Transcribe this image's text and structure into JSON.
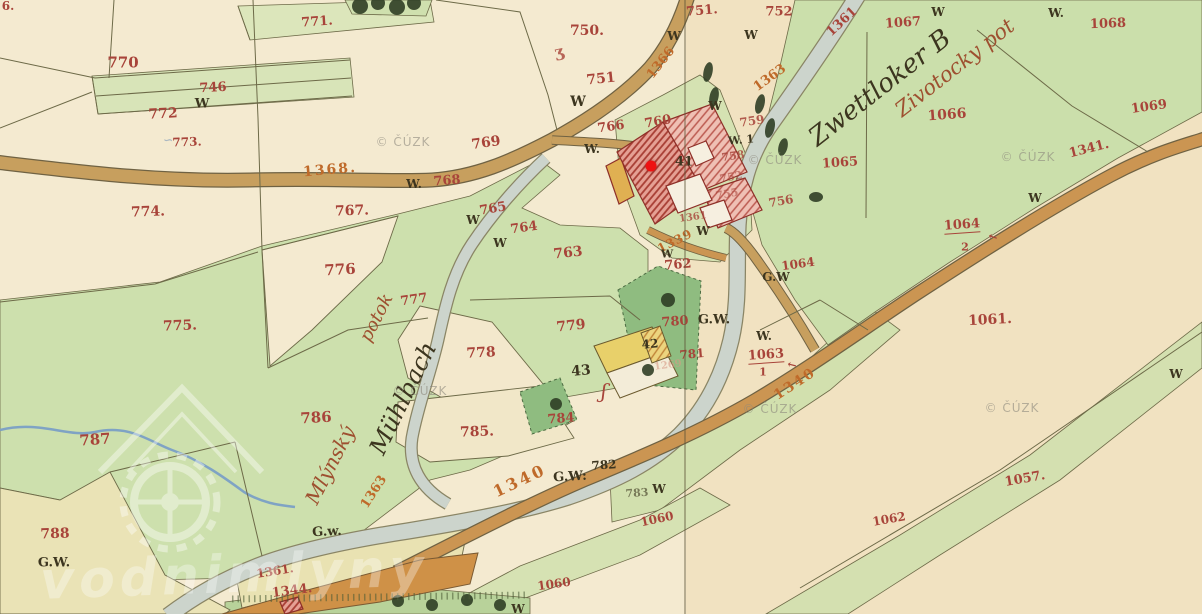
{
  "meta": {
    "description": "Historical cadastral map sheet (19th century) with hand-written parcel numbers, a mill stream and a highlighted water-mill site",
    "copyright_watermark": "© ČÚZK",
    "site_watermark_text": "vodnimlyny",
    "sheet_seam_x": 684
  },
  "marker": {
    "name": "mill-location-marker",
    "x": 651,
    "y": 166,
    "color": "#ee1212"
  },
  "colors": {
    "red": "#a8443a",
    "orange": "#bf6a2a",
    "dark": "#3c351f",
    "scriptred": "#9e5030",
    "salmon": "#d89a86",
    "blue": "#6f8fb5"
  },
  "watermarks": {
    "cuzk_text": "© ČÚZK",
    "cuzk_positions": [
      [
        403,
        142
      ],
      [
        775,
        160
      ],
      [
        1028,
        157
      ],
      [
        420,
        391
      ],
      [
        770,
        409
      ],
      [
        1012,
        408
      ]
    ],
    "logo_text": "vodnimlyny",
    "logo_text_x": 40,
    "logo_text_y": 545,
    "logo_text_size": 52
  },
  "labels": [
    {
      "t": "771.",
      "x": 317,
      "y": 22,
      "s": 13,
      "r": -4,
      "c": "red"
    },
    {
      "t": "746",
      "x": 213,
      "y": 88,
      "s": 13,
      "r": -3,
      "c": "red"
    },
    {
      "t": "772",
      "x": 163,
      "y": 114,
      "s": 14,
      "r": -3,
      "c": "red"
    },
    {
      "t": "773.",
      "x": 187,
      "y": 142,
      "s": 12,
      "r": -2,
      "c": "red"
    },
    {
      "t": "∽",
      "x": 168,
      "y": 140,
      "s": 12,
      "r": 0,
      "c": "blue",
      "o": 0.55
    },
    {
      "t": "770",
      "x": 123,
      "y": 63,
      "s": 15,
      "r": 0,
      "c": "red"
    },
    {
      "t": "750.",
      "x": 587,
      "y": 31,
      "s": 14,
      "r": 0,
      "c": "red"
    },
    {
      "t": "ʒ",
      "x": 559,
      "y": 52,
      "s": 16,
      "r": -12,
      "c": "red",
      "o": 0.8
    },
    {
      "t": "751",
      "x": 601,
      "y": 79,
      "s": 14,
      "r": -6,
      "c": "red"
    },
    {
      "t": "751.",
      "x": 702,
      "y": 11,
      "s": 13,
      "r": -5,
      "c": "red"
    },
    {
      "t": "752",
      "x": 779,
      "y": 12,
      "s": 13,
      "r": 0,
      "c": "red"
    },
    {
      "t": "769",
      "x": 486,
      "y": 143,
      "s": 14,
      "r": -8,
      "c": "red"
    },
    {
      "t": "768",
      "x": 447,
      "y": 181,
      "s": 13,
      "r": -4,
      "c": "red"
    },
    {
      "t": "766",
      "x": 611,
      "y": 127,
      "s": 13,
      "r": -8,
      "c": "red"
    },
    {
      "t": "760",
      "x": 658,
      "y": 122,
      "s": 13,
      "r": -10,
      "c": "red"
    },
    {
      "t": "765",
      "x": 493,
      "y": 209,
      "s": 13,
      "r": -10,
      "c": "red"
    },
    {
      "t": "764",
      "x": 524,
      "y": 228,
      "s": 13,
      "r": -8,
      "c": "red"
    },
    {
      "t": "763",
      "x": 568,
      "y": 253,
      "s": 14,
      "r": -6,
      "c": "red"
    },
    {
      "t": "774.",
      "x": 148,
      "y": 212,
      "s": 14,
      "r": -2,
      "c": "red"
    },
    {
      "t": "767.",
      "x": 352,
      "y": 211,
      "s": 14,
      "r": -2,
      "c": "red"
    },
    {
      "t": "776",
      "x": 340,
      "y": 270,
      "s": 15,
      "r": -3,
      "c": "red"
    },
    {
      "t": "775.",
      "x": 180,
      "y": 326,
      "s": 14,
      "r": -2,
      "c": "red"
    },
    {
      "t": "777",
      "x": 414,
      "y": 300,
      "s": 13,
      "r": -8,
      "c": "red"
    },
    {
      "t": "779",
      "x": 571,
      "y": 326,
      "s": 14,
      "r": -6,
      "c": "red"
    },
    {
      "t": "778",
      "x": 481,
      "y": 353,
      "s": 14,
      "r": -3,
      "c": "red"
    },
    {
      "t": "785.",
      "x": 477,
      "y": 432,
      "s": 14,
      "r": -2,
      "c": "red"
    },
    {
      "t": "784",
      "x": 561,
      "y": 419,
      "s": 13,
      "r": -4,
      "c": "red"
    },
    {
      "t": "786",
      "x": 316,
      "y": 418,
      "s": 15,
      "r": -3,
      "c": "red"
    },
    {
      "t": "787",
      "x": 95,
      "y": 440,
      "s": 15,
      "r": -4,
      "c": "red"
    },
    {
      "t": "788",
      "x": 55,
      "y": 534,
      "s": 14,
      "r": -2,
      "c": "red"
    },
    {
      "t": "759",
      "x": 752,
      "y": 121,
      "s": 12,
      "r": -8,
      "c": "red",
      "o": 0.85
    },
    {
      "t": "758",
      "x": 733,
      "y": 156,
      "s": 11,
      "r": -8,
      "c": "red",
      "o": 0.8
    },
    {
      "t": "752",
      "x": 731,
      "y": 177,
      "s": 11,
      "r": -10,
      "c": "red",
      "o": 0.6
    },
    {
      "t": "755",
      "x": 727,
      "y": 194,
      "s": 11,
      "r": -10,
      "c": "red",
      "o": 0.55
    },
    {
      "t": "756",
      "x": 781,
      "y": 201,
      "s": 12,
      "r": -10,
      "c": "red",
      "o": 0.9
    },
    {
      "t": "1361",
      "x": 693,
      "y": 218,
      "s": 10,
      "r": -8,
      "c": "red",
      "o": 0.8
    },
    {
      "t": "762",
      "x": 678,
      "y": 265,
      "s": 13,
      "r": -5,
      "c": "red"
    },
    {
      "t": "781",
      "x": 692,
      "y": 354,
      "s": 12,
      "r": -5,
      "c": "red"
    },
    {
      "t": "1269",
      "x": 668,
      "y": 366,
      "s": 10,
      "r": -8,
      "c": "salmon",
      "o": 0.6
    },
    {
      "t": "780",
      "x": 675,
      "y": 322,
      "s": 13,
      "r": -4,
      "c": "red"
    },
    {
      "t": "1060",
      "x": 657,
      "y": 519,
      "s": 12,
      "r": -12,
      "c": "red"
    },
    {
      "t": "1060",
      "x": 554,
      "y": 584,
      "s": 12,
      "r": -8,
      "c": "red"
    },
    {
      "t": "1057.",
      "x": 1025,
      "y": 479,
      "s": 13,
      "r": -10,
      "c": "red"
    },
    {
      "t": "1062",
      "x": 889,
      "y": 519,
      "s": 12,
      "r": -10,
      "c": "red"
    },
    {
      "t": "1061.",
      "x": 990,
      "y": 320,
      "s": 14,
      "r": -3,
      "c": "red"
    },
    {
      "t": "1063",
      "x": 766,
      "y": 356,
      "s": 13,
      "r": -4,
      "c": "red",
      "u": true
    },
    {
      "t": "1",
      "x": 763,
      "y": 372,
      "s": 11,
      "r": 0,
      "c": "red"
    },
    {
      "t": "←",
      "x": 792,
      "y": 365,
      "s": 11,
      "r": 14,
      "c": "red"
    },
    {
      "t": "1064",
      "x": 962,
      "y": 226,
      "s": 13,
      "r": -4,
      "c": "red",
      "u": true
    },
    {
      "t": "2",
      "x": 965,
      "y": 247,
      "s": 11,
      "r": 0,
      "c": "red"
    },
    {
      "t": "←",
      "x": 993,
      "y": 237,
      "s": 11,
      "r": 18,
      "c": "red"
    },
    {
      "t": "1064",
      "x": 798,
      "y": 264,
      "s": 12,
      "r": -8,
      "c": "red"
    },
    {
      "t": "1065",
      "x": 840,
      "y": 163,
      "s": 13,
      "r": -4,
      "c": "red"
    },
    {
      "t": "1066",
      "x": 947,
      "y": 115,
      "s": 14,
      "r": -4,
      "c": "red"
    },
    {
      "t": "1067",
      "x": 903,
      "y": 23,
      "s": 13,
      "r": -4,
      "c": "red"
    },
    {
      "t": "1068",
      "x": 1108,
      "y": 24,
      "s": 13,
      "r": -2,
      "c": "red"
    },
    {
      "t": "1069",
      "x": 1149,
      "y": 107,
      "s": 13,
      "r": -8,
      "c": "red"
    },
    {
      "t": "1341.",
      "x": 1089,
      "y": 149,
      "s": 13,
      "r": -14,
      "c": "red"
    },
    {
      "t": "1361",
      "x": 842,
      "y": 22,
      "s": 13,
      "r": -43,
      "c": "red"
    },
    {
      "t": "1361.",
      "x": 275,
      "y": 571,
      "s": 12,
      "r": -9,
      "c": "red"
    },
    {
      "t": "1344.",
      "x": 292,
      "y": 591,
      "s": 13,
      "r": -7,
      "c": "red"
    },
    {
      "t": "6.",
      "x": 8,
      "y": 6,
      "s": 12,
      "r": 0,
      "c": "red"
    },
    {
      "t": "1368.",
      "x": 330,
      "y": 170,
      "s": 14,
      "r": -5,
      "c": "orange",
      "ls": 2
    },
    {
      "t": "1366",
      "x": 661,
      "y": 63,
      "s": 13,
      "r": -52,
      "c": "orange"
    },
    {
      "t": "1363",
      "x": 770,
      "y": 78,
      "s": 13,
      "r": -36,
      "c": "orange"
    },
    {
      "t": "1363",
      "x": 374,
      "y": 492,
      "s": 13,
      "r": -57,
      "c": "orange"
    },
    {
      "t": "1340",
      "x": 520,
      "y": 481,
      "s": 16,
      "r": -25,
      "c": "orange",
      "ls": 3
    },
    {
      "t": "1340",
      "x": 795,
      "y": 384,
      "s": 14,
      "r": -33,
      "c": "orange",
      "ls": 2
    },
    {
      "t": "1339",
      "x": 675,
      "y": 241,
      "s": 12,
      "r": -27,
      "c": "orange",
      "ls": 1
    },
    {
      "t": "W",
      "x": 202,
      "y": 104,
      "s": 13,
      "r": 0,
      "c": "dark"
    },
    {
      "t": "W",
      "x": 578,
      "y": 102,
      "s": 14,
      "r": 0,
      "c": "dark"
    },
    {
      "t": "W",
      "x": 674,
      "y": 36,
      "s": 12,
      "r": 0,
      "c": "dark"
    },
    {
      "t": "W.",
      "x": 592,
      "y": 149,
      "s": 12,
      "r": 0,
      "c": "dark"
    },
    {
      "t": "W.",
      "x": 414,
      "y": 184,
      "s": 12,
      "r": 0,
      "c": "dark"
    },
    {
      "t": "W",
      "x": 473,
      "y": 220,
      "s": 12,
      "r": 0,
      "c": "dark"
    },
    {
      "t": "W",
      "x": 500,
      "y": 243,
      "s": 12,
      "r": 0,
      "c": "dark"
    },
    {
      "t": "W",
      "x": 715,
      "y": 106,
      "s": 12,
      "r": 0,
      "c": "dark"
    },
    {
      "t": "W",
      "x": 751,
      "y": 35,
      "s": 12,
      "r": 0,
      "c": "dark"
    },
    {
      "t": "W",
      "x": 938,
      "y": 12,
      "s": 12,
      "r": 0,
      "c": "dark"
    },
    {
      "t": "W.",
      "x": 1056,
      "y": 13,
      "s": 12,
      "r": 0,
      "c": "dark"
    },
    {
      "t": "W. 1",
      "x": 741,
      "y": 140,
      "s": 11,
      "r": -5,
      "c": "dark"
    },
    {
      "t": "W",
      "x": 703,
      "y": 231,
      "s": 12,
      "r": 0,
      "c": "dark"
    },
    {
      "t": "W",
      "x": 667,
      "y": 254,
      "s": 11,
      "r": 0,
      "c": "dark"
    },
    {
      "t": "W.",
      "x": 764,
      "y": 336,
      "s": 12,
      "r": 0,
      "c": "dark"
    },
    {
      "t": "W",
      "x": 1035,
      "y": 198,
      "s": 12,
      "r": 0,
      "c": "dark"
    },
    {
      "t": "W",
      "x": 1176,
      "y": 374,
      "s": 12,
      "r": 0,
      "c": "dark"
    },
    {
      "t": "W",
      "x": 659,
      "y": 489,
      "s": 12,
      "r": 0,
      "c": "dark"
    },
    {
      "t": "W",
      "x": 518,
      "y": 609,
      "s": 12,
      "r": 0,
      "c": "dark"
    },
    {
      "t": "G.W.",
      "x": 54,
      "y": 563,
      "s": 13,
      "r": 0,
      "c": "dark"
    },
    {
      "t": "G.w.",
      "x": 327,
      "y": 532,
      "s": 13,
      "r": -3,
      "c": "dark"
    },
    {
      "t": "G.W:",
      "x": 570,
      "y": 477,
      "s": 13,
      "r": -3,
      "c": "dark"
    },
    {
      "t": "G.W.",
      "x": 714,
      "y": 320,
      "s": 13,
      "r": 0,
      "c": "dark"
    },
    {
      "t": "G.W",
      "x": 776,
      "y": 277,
      "s": 12,
      "r": 0,
      "c": "dark"
    },
    {
      "t": "41",
      "x": 684,
      "y": 162,
      "s": 13,
      "r": 0,
      "c": "dark"
    },
    {
      "t": "43",
      "x": 581,
      "y": 371,
      "s": 14,
      "r": -5,
      "c": "dark"
    },
    {
      "t": "42",
      "x": 650,
      "y": 344,
      "s": 12,
      "r": -5,
      "c": "dark"
    },
    {
      "t": "782",
      "x": 604,
      "y": 465,
      "s": 12,
      "r": -4,
      "c": "dark"
    },
    {
      "t": "783",
      "x": 637,
      "y": 493,
      "s": 11,
      "r": -4,
      "c": "dark",
      "o": 0.6
    },
    {
      "t": "ʃ",
      "x": 604,
      "y": 391,
      "s": 20,
      "r": 5,
      "c": "red",
      "f": "script"
    },
    {
      "t": "Mlýnský",
      "x": 330,
      "y": 465,
      "s": 20,
      "r": -63,
      "c": "scriptred",
      "f": "script"
    },
    {
      "t": "potok",
      "x": 377,
      "y": 318,
      "s": 18,
      "r": -63,
      "c": "scriptred",
      "f": "script"
    },
    {
      "t": "Mühlbach",
      "x": 403,
      "y": 398,
      "s": 24,
      "r": -64,
      "c": "dark",
      "f": "script"
    },
    {
      "t": "Zwettloker B",
      "x": 880,
      "y": 88,
      "s": 26,
      "r": -38,
      "c": "dark",
      "f": "script"
    },
    {
      "t": "Zivotocky pot",
      "x": 955,
      "y": 68,
      "s": 21,
      "r": -38,
      "c": "scriptred",
      "f": "script"
    }
  ]
}
